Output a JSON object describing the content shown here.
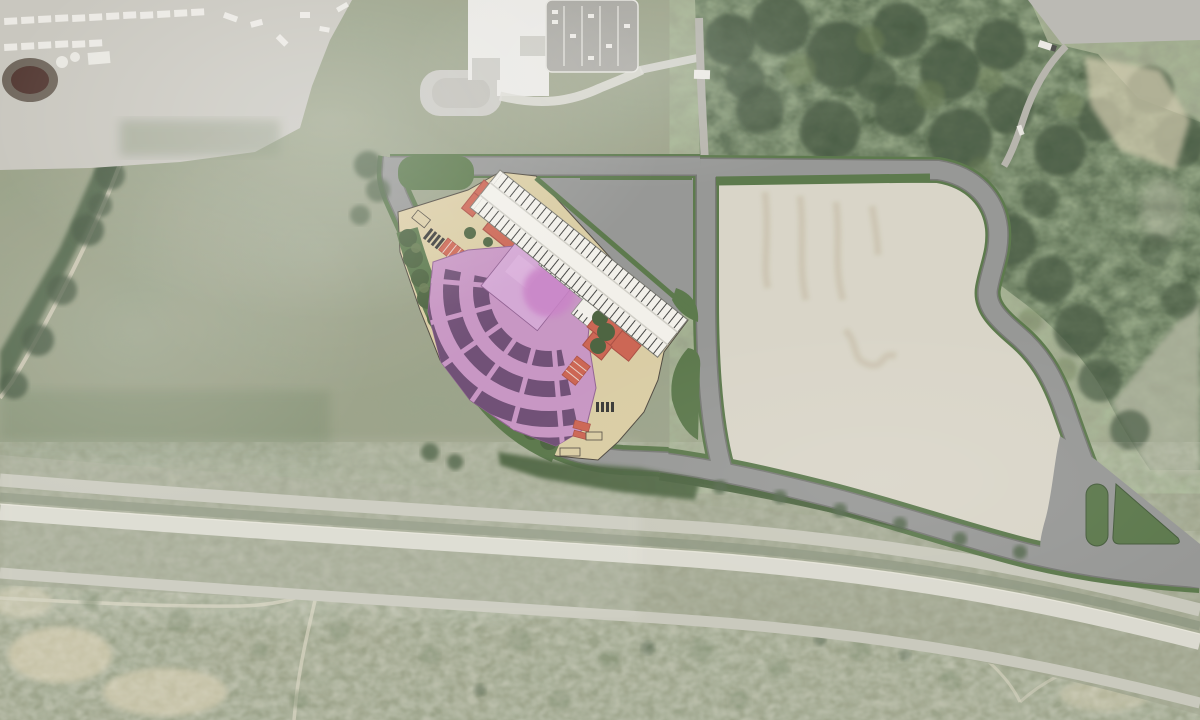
{
  "scene": {
    "kind": "aerial-photo-with-site-plan-overlay",
    "description": "Satellite aerial photograph of a highway-side parcel with a rendered amphitheater site plan overlaid: fan-shaped seating bowl, stage, support buildings, service parking strip, landscaped berm, access loop roads and a large graded future parking field",
    "visible_text": [],
    "features": [
      "industrial-yard",
      "trailer-rows",
      "retention-pond",
      "school-campus",
      "school-parking-lot",
      "tree-line-road",
      "open-fields",
      "woodland",
      "clearing-pavement",
      "service-truck",
      "amphitheater-seating-bowl",
      "seating-tiers",
      "stage",
      "stage-house",
      "support-buildings",
      "plaza",
      "landscape-berm",
      "parking-strip",
      "service-parking",
      "loop-road",
      "access-road",
      "green-islands",
      "future-parking-field",
      "road-junction-medians",
      "highway-corridor",
      "frontage-road",
      "scrub-field",
      "dirt-paths",
      "sand-patches",
      "atmospheric-haze"
    ]
  },
  "palette": {
    "base": "#9aa086",
    "field_light": "#adb29b",
    "scrub": "#7d8b6d",
    "woods": "#4f6347",
    "woods_deep": "#42553e",
    "canopy": "#66794f",
    "dirt_track": "#ccc7b2",
    "concrete": "#c7c5bd",
    "white_unit": "#ebe9e3",
    "pond": "#4e332d",
    "tank": "#e8e6e0",
    "school_white": "#e9e8e3",
    "school_court": "#c9c8c1",
    "lot": "#a5a49e",
    "lot_line": "#d9d8d2",
    "road": "#939492",
    "road_edge": "#737470",
    "road_minor": "#b4b2aa",
    "pave": "#b8b7b1",
    "green": "#567446",
    "green_dark": "#475f3a",
    "beige": "#d8d4c6",
    "streak": "#bcb098",
    "plaza": "#d9cba1",
    "plaza_line": "#4a443a",
    "strip": "#f2f0ea",
    "hatch": "#3f3f3d",
    "bowl": "#c693c2",
    "seat": "#6b4a71",
    "stage": "#d3a6d4",
    "magenta": "#c77fc5",
    "red": "#ca614e",
    "red_dark": "#a84a3e",
    "black": "#333331",
    "hwy_base": "#9ba189",
    "hwy_pale": "#c7c7ba",
    "hwy_bright": "#dad9ce",
    "hwy_grass": "#8b947d",
    "sand": "#d0c9ac",
    "path": "#cdcab5",
    "haze": "#ffffff"
  }
}
